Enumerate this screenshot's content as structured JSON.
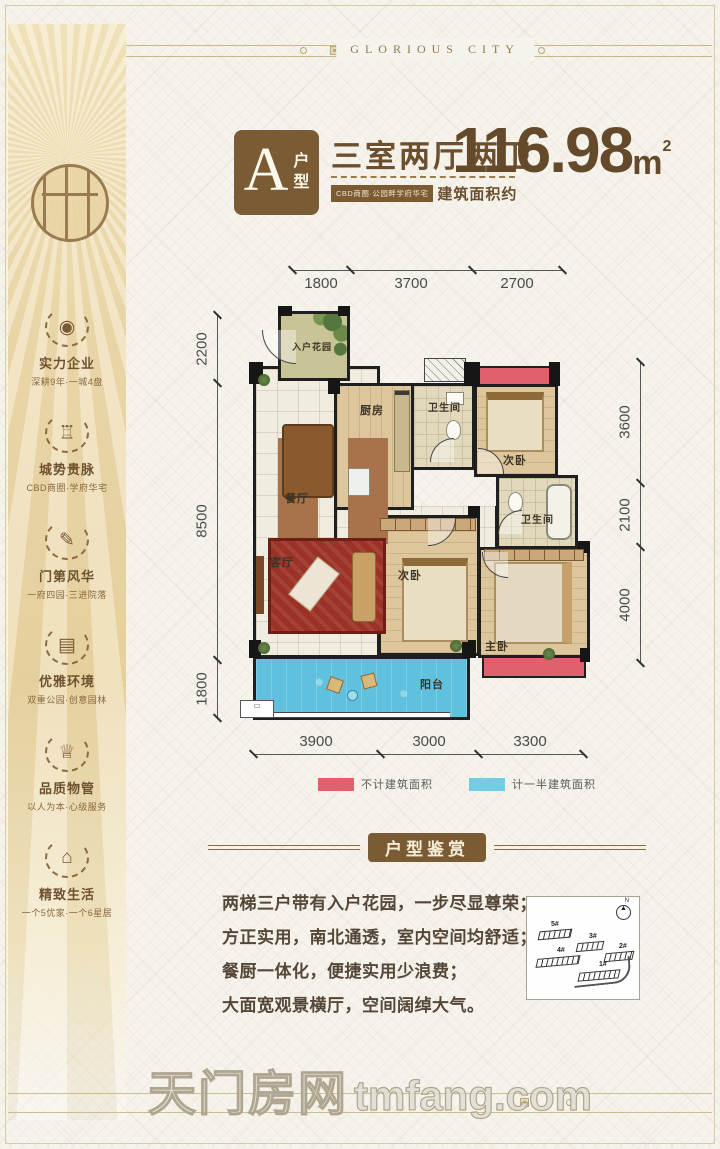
{
  "page": {
    "brand_en": "GLORIOUS CITY"
  },
  "sidebar": {
    "items": [
      {
        "icon": "location-pin-icon",
        "title": "实力企业",
        "subtitle": "深耕9年·一城4盘"
      },
      {
        "icon": "throne-icon",
        "title": "城势贵脉",
        "subtitle": "CBD商圈·学府华宅"
      },
      {
        "icon": "pen-nib-icon",
        "title": "门第风华",
        "subtitle": "一府四园·三进院落"
      },
      {
        "icon": "books-icon",
        "title": "优雅环境",
        "subtitle": "双重公园·创意园林"
      },
      {
        "icon": "crown-icon",
        "title": "品质物管",
        "subtitle": "以人为本·心级服务"
      },
      {
        "icon": "pavilion-icon",
        "title": "精致生活",
        "subtitle": "一个5优家·一个6星居"
      }
    ]
  },
  "header": {
    "unit_letter": "A",
    "unit_label_1": "户",
    "unit_label_2": "型",
    "spec": "三室两厅两卫",
    "tagline": "CBD商圈·公园畔学府华宅",
    "area_label": "建筑面积约",
    "area_value": "116.98",
    "area_unit": "m",
    "area_sup": "2"
  },
  "floorplan": {
    "dims_top": [
      "1800",
      "3700",
      "2700"
    ],
    "dims_left": [
      "2200",
      "8500",
      "1800"
    ],
    "dims_right": [
      "3600",
      "2100",
      "4000"
    ],
    "dims_bottom": [
      "3900",
      "3000",
      "3300"
    ],
    "rooms": {
      "entry_garden": "入户花园",
      "kitchen": "厨房",
      "bath1": "卫生间",
      "bedroom_top": "次卧",
      "bath2": "卫生间",
      "dining": "餐厅",
      "living": "客厅",
      "bedroom_mid": "次卧",
      "master": "主卧",
      "balcony": "阳台"
    },
    "legend": [
      {
        "color": "#e0606e",
        "label": "不计建筑面积"
      },
      {
        "color": "#74cbe4",
        "label": "计一半建筑面积"
      }
    ]
  },
  "appreciation": {
    "title": "户型鉴赏",
    "lines": [
      "两梯三户带有入户花园，一步尽显尊荣；",
      "方正实用，南北通透，室内空间均舒适；",
      "餐厨一体化，便捷实用少浪费；",
      "大面宽观景横厅，空间阔绰大气。"
    ]
  },
  "sitemap": {
    "buildings": [
      "5#",
      "3#",
      "2#",
      "4#",
      "1#"
    ],
    "north_label": "N"
  },
  "watermark": {
    "cn": "天门房网",
    "en": "tmfang.com"
  },
  "colors": {
    "accent_brown": "#7b5b34",
    "text_brown": "#6b4f2e",
    "gold_line": "#cdbd92",
    "red_area": "#e0606e",
    "blue_area": "#74cbe4"
  }
}
